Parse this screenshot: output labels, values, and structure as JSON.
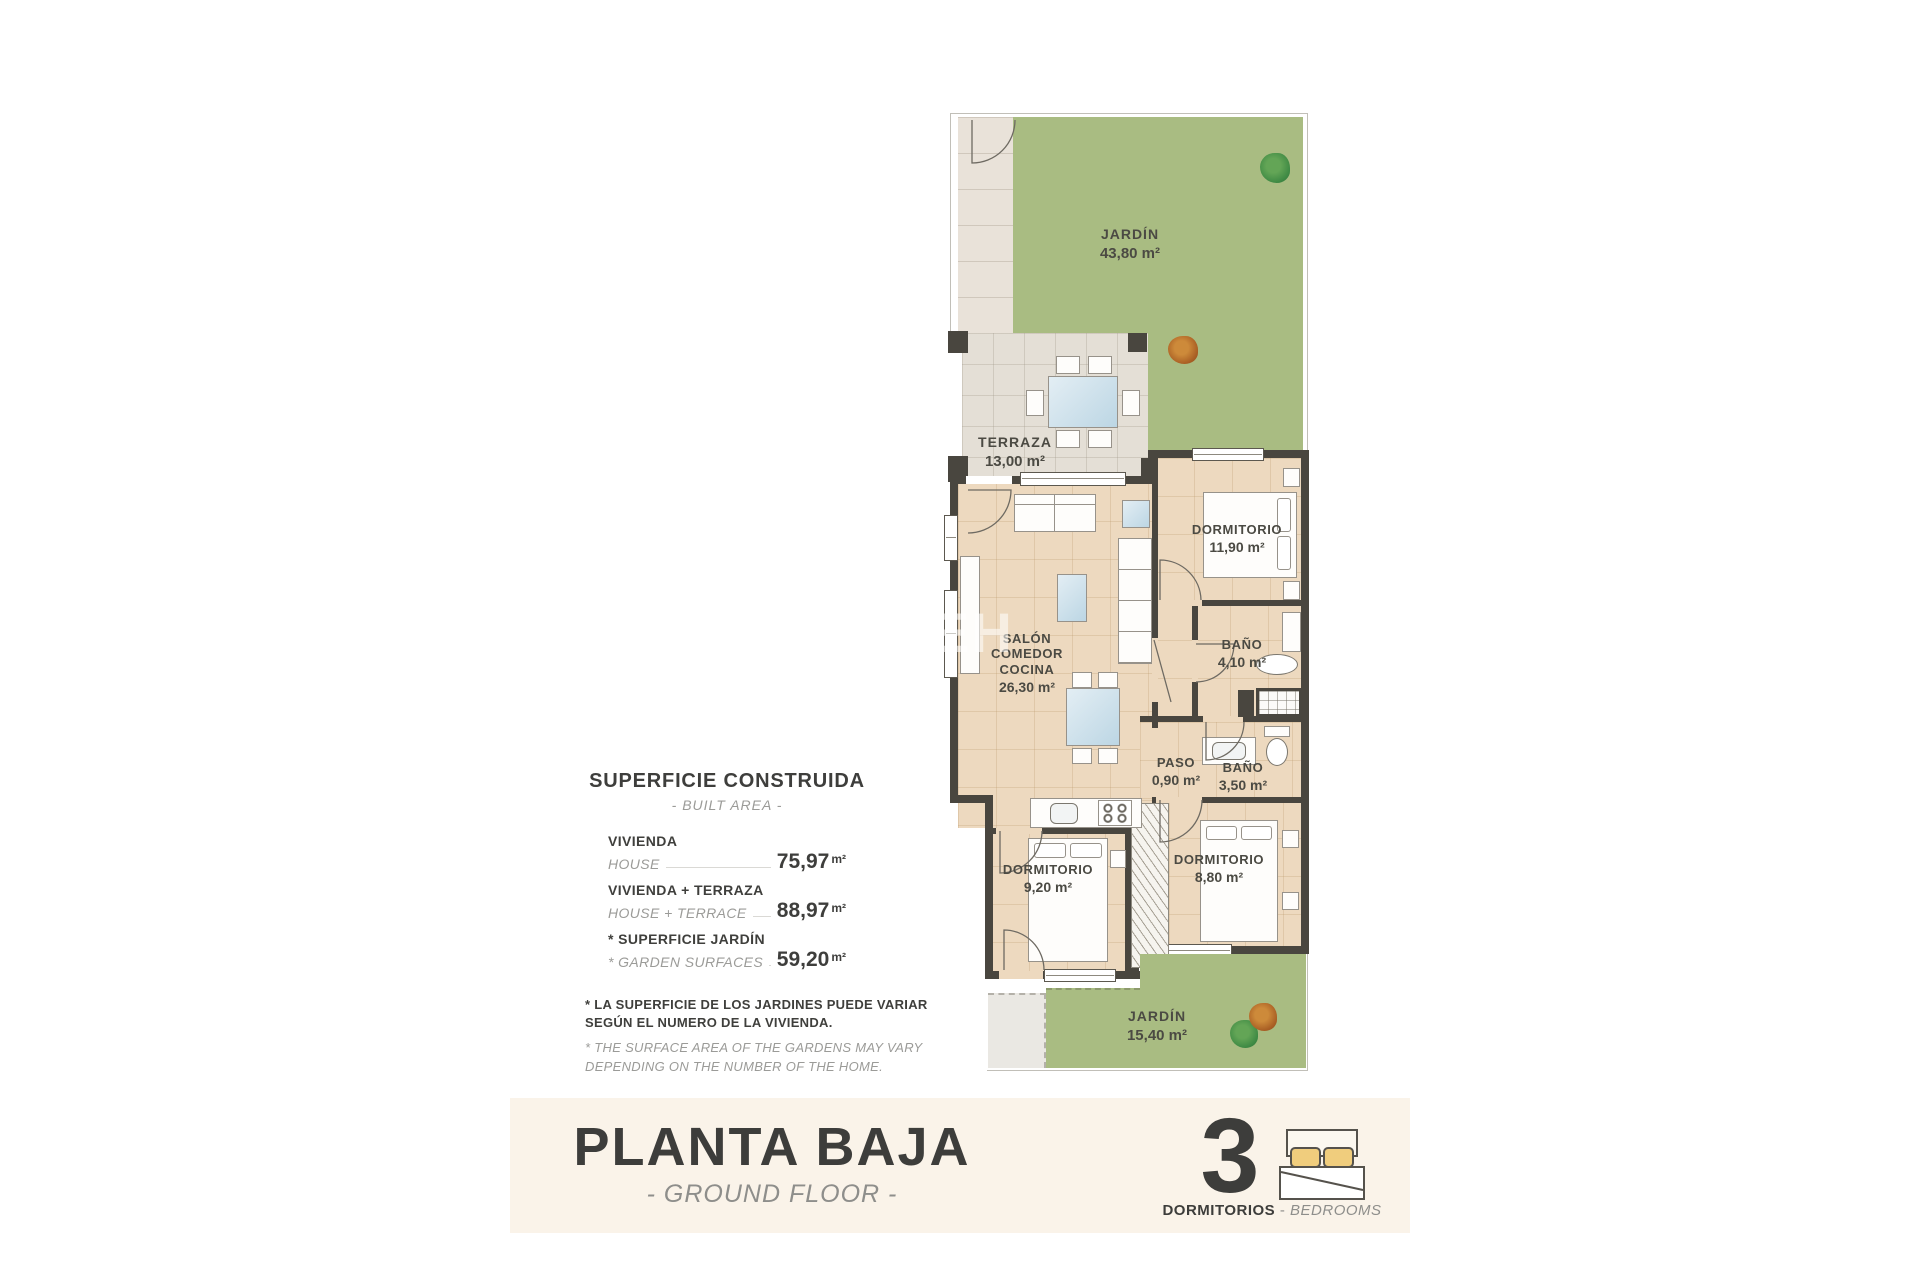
{
  "plan": {
    "rooms": {
      "garden_top": {
        "name": "JARDÍN",
        "area": "43,80 m²"
      },
      "terrace": {
        "name": "TERRAZA",
        "area": "13,00 m²"
      },
      "living": {
        "line1": "SALÓN",
        "line2": "COMEDOR",
        "line3": "COCINA",
        "area": "26,30 m²"
      },
      "bedroom1": {
        "name": "DORMITORIO",
        "area": "11,90 m²"
      },
      "bath1": {
        "name": "BAÑO",
        "area": "4,10 m²"
      },
      "hall": {
        "name": "PASO",
        "area": "0,90 m²"
      },
      "bath2": {
        "name": "BAÑO",
        "area": "3,50 m²"
      },
      "bedroom2": {
        "name": "DORMITORIO",
        "area": "9,20 m²"
      },
      "bedroom3": {
        "name": "DORMITORIO",
        "area": "8,80 m²"
      },
      "garden_bottom": {
        "name": "JARDÍN",
        "area": "15,40 m²"
      }
    },
    "watermark": "EH"
  },
  "summary": {
    "title": "SUPERFICIE CONSTRUIDA",
    "subtitle": "- BUILT AREA -",
    "rows": [
      {
        "label_es": "VIVIENDA",
        "label_en": "HOUSE",
        "value": "75,97",
        "unit": "m²"
      },
      {
        "label_es": "VIVIENDA + TERRAZA",
        "label_en": "HOUSE + TERRACE",
        "value": "88,97",
        "unit": "m²"
      },
      {
        "label_es": "* SUPERFICIE JARDÍN",
        "label_en": "* GARDEN SURFACES",
        "value": "59,20",
        "unit": "m²"
      }
    ]
  },
  "footnote": {
    "es": "* LA SUPERFICIE DE LOS JARDINES PUEDE VARIAR SEGÚN EL NUMERO DE LA VIVIENDA.",
    "en": "* THE SURFACE AREA OF THE GARDENS MAY VARY DEPENDING ON THE NUMBER OF THE HOME."
  },
  "footer": {
    "title": "PLANTA BAJA",
    "subtitle": "- GROUND FLOOR -",
    "bedrooms_count": "3",
    "bedrooms_label_es": "DORMITORIOS",
    "bedrooms_separator": "-",
    "bedrooms_label_en": "BEDROOMS"
  },
  "colors": {
    "garden_green": "#a9bc82",
    "floor_beige": "#edd9bf",
    "terrace_grey": "#e4dfd6",
    "wall_dark": "#49463f",
    "footer_cream": "#faf3e9",
    "pillow_yellow": "#f0cd7d"
  }
}
